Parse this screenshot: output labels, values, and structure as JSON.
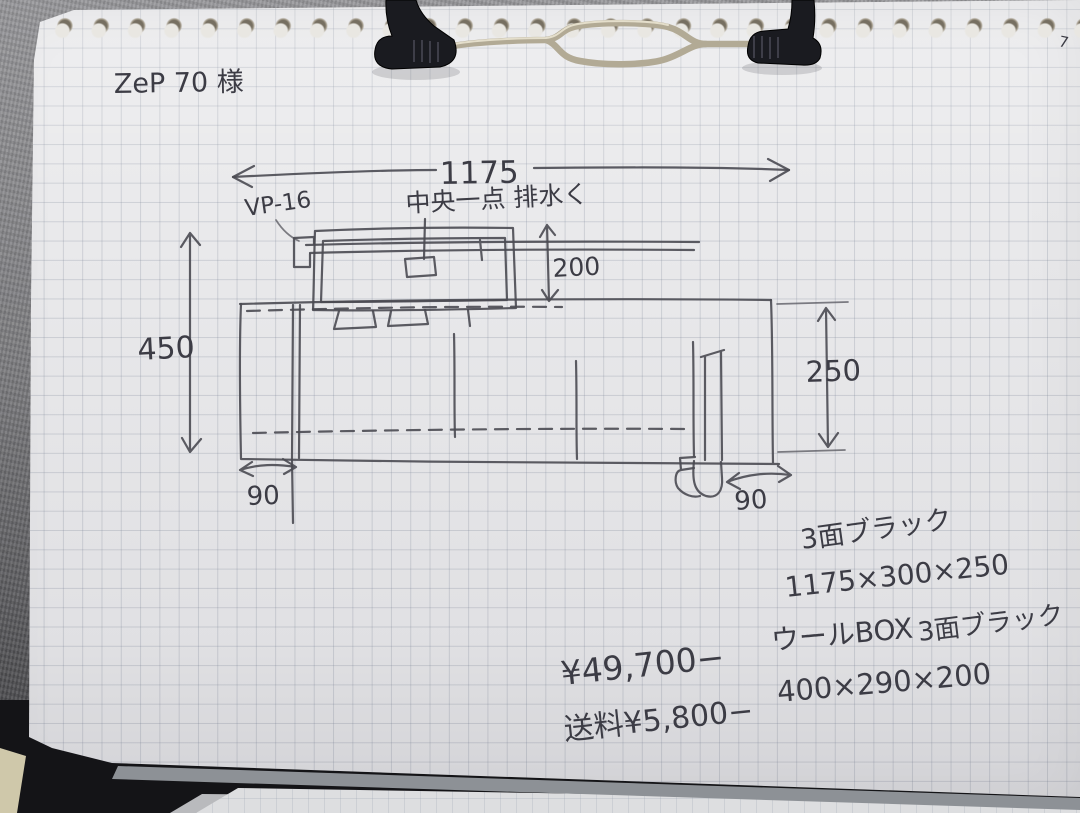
{
  "header": {
    "customer": "ZeP 70 様",
    "corner_mark": "7"
  },
  "sketch": {
    "dim_overall": "1175",
    "pipe_label": "VP-16",
    "center_note": "中央一点 排水く",
    "dim_height_left": "450",
    "dim_drop": "200",
    "dim_height_right": "250",
    "dim_left_chamber": "90",
    "dim_right_chamber": "90"
  },
  "specs": {
    "finish_main": "3面ブラック",
    "size_main": "1175×300×250",
    "wool_box": "ウールBOX",
    "finish_wool": "3面ブラック",
    "size_wool": "400×290×200"
  },
  "pricing": {
    "price": "¥49,700−",
    "shipping": "送料¥5,800−"
  }
}
